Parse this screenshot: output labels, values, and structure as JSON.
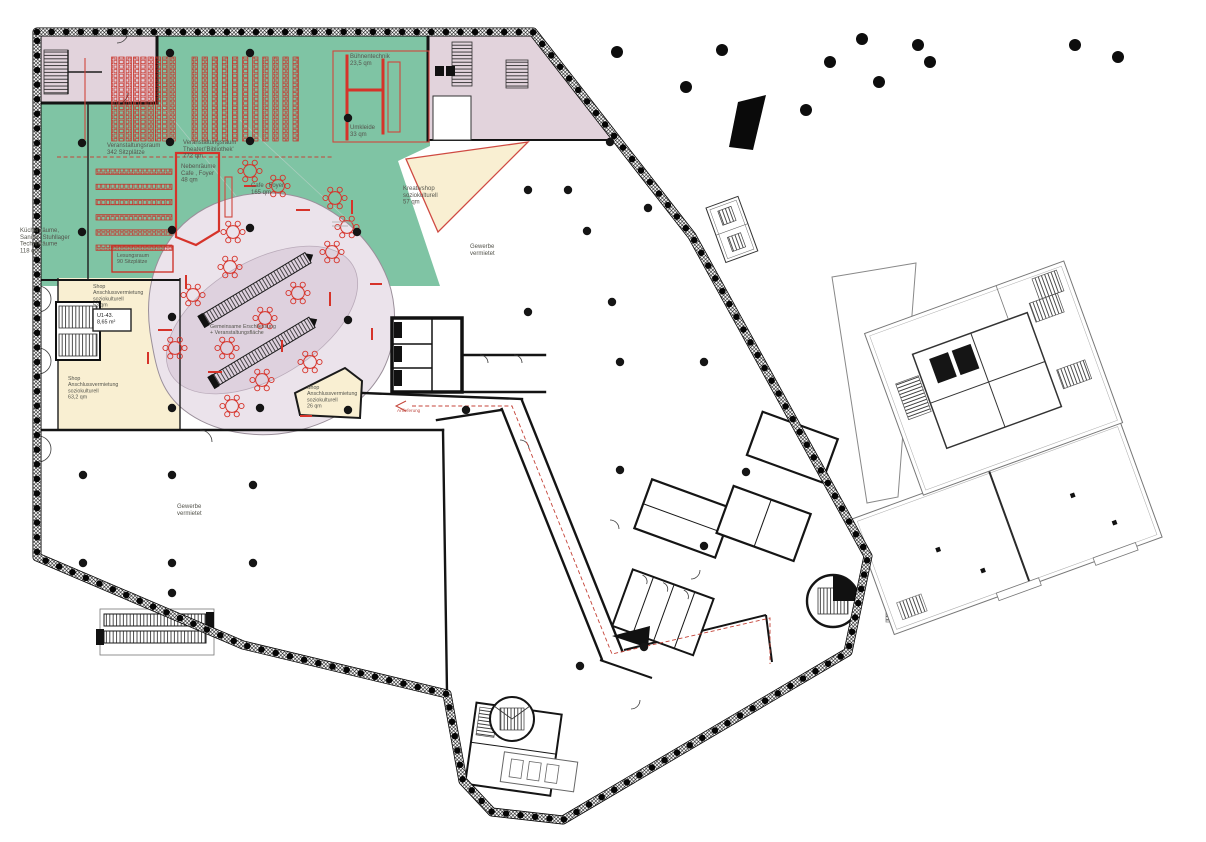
{
  "title": "Erdgeschoss Grundriss (floor plan)",
  "colors": {
    "zone_event_green": "#7fc4a4",
    "zone_circulation_mauve": "#e2d3dc",
    "zone_shop_cream": "#f9efd2",
    "zone_plaza_outer": "#ebe3eb",
    "zone_plaza_inner": "#ded1de",
    "accent_red": "#d6332a",
    "wall_black": "#141414",
    "existing_gray": "#7d7d7d",
    "label_gray": "#55554d"
  },
  "labels": {
    "veranstaltungsraum_342": {
      "lines": [
        "Veranstaltungsraum",
        "342 Sitzplätze"
      ]
    },
    "veranstaltungsraum_theater": {
      "lines": [
        "Veranstaltungsraum",
        "Theater/'Bibliothek'",
        "772 qm"
      ]
    },
    "buehnentechnik": {
      "lines": [
        "Bühnentechnik",
        "23,5 qm"
      ]
    },
    "umkleide": {
      "lines": [
        "Umkleide",
        "33 qm"
      ]
    },
    "nebenraeume_cafe": {
      "lines": [
        "Nebenräume",
        "Cafe , Foyer",
        "48 qm"
      ]
    },
    "cafe_foyer": {
      "lines": [
        "Cafe , Foyer",
        "165 qm"
      ]
    },
    "kreativshop": {
      "lines": [
        "Kreativshop",
        "soziokulturell",
        "57 qm"
      ]
    },
    "kuechenraeume": {
      "lines": [
        "Küchenräume,",
        "Sanitär- Stuhllager",
        "Technikräume",
        "118 qm"
      ]
    },
    "lesungsraum": {
      "lines": [
        "Lesungsraum",
        "90 Sitzplätze"
      ]
    },
    "shop_53": {
      "lines": [
        "Shop",
        "Anschlussvermietung",
        "soziokulturell",
        "53 qm"
      ]
    },
    "u1_43": {
      "lines": [
        "U1-43.",
        "8,65 m²"
      ]
    },
    "shop_63": {
      "lines": [
        "Shop",
        "Anschlussvermietung",
        "soziokulturell",
        "63,2 qm"
      ]
    },
    "shop_26": {
      "lines": [
        "Shop",
        "Anschlussvermietung",
        "soziokulturell",
        "26 qm"
      ]
    },
    "gemeinsame": {
      "lines": [
        "Gemeinsame  Erschliessung",
        "+ Veranstaltungsfläche"
      ]
    },
    "gewerbe_right": {
      "lines": [
        "Gewerbe",
        "vermietet"
      ]
    },
    "gewerbe_left": {
      "lines": [
        "Gewerbe",
        "vermietet"
      ]
    },
    "anlieferung": {
      "lines": [
        "Anlieferung"
      ]
    }
  }
}
